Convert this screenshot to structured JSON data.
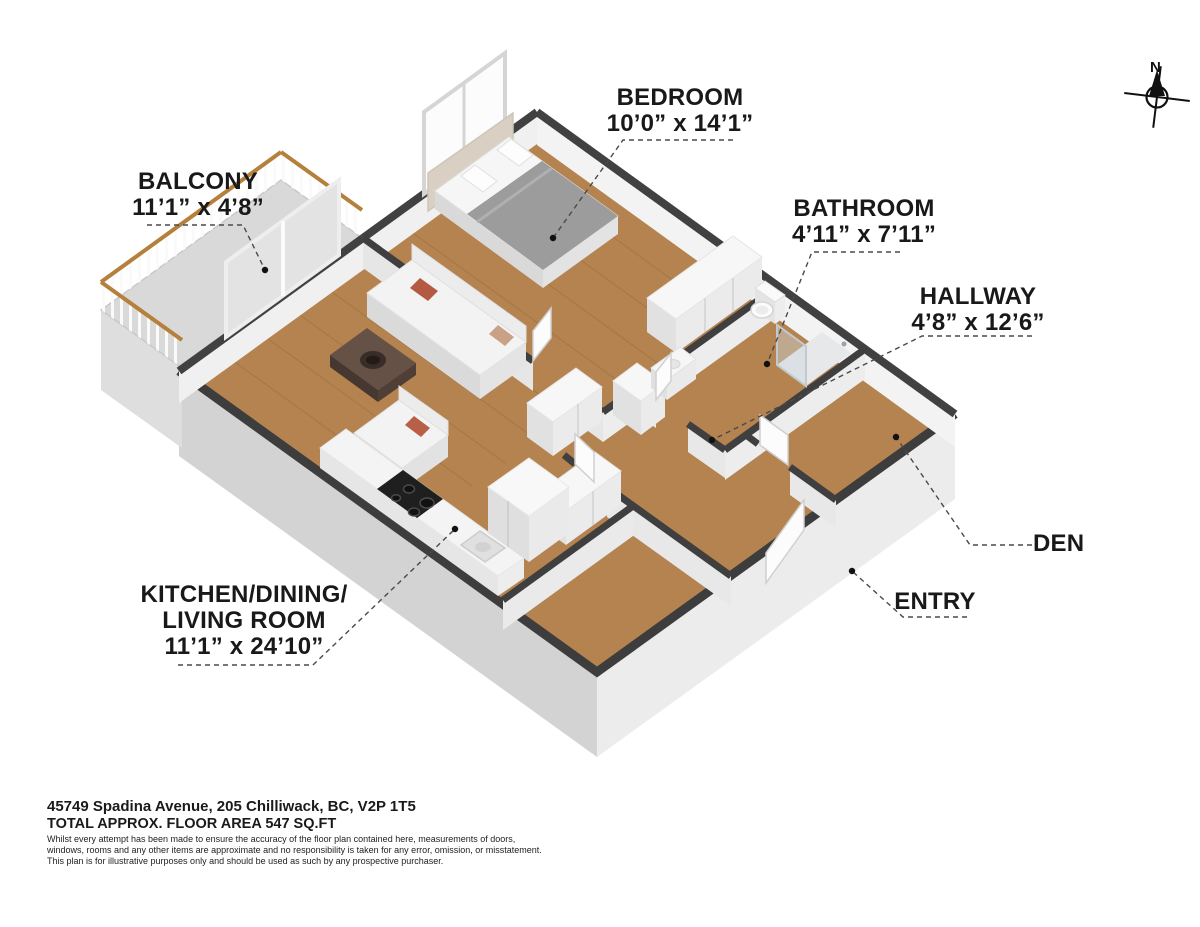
{
  "compass": {
    "label": "N"
  },
  "rooms": {
    "bedroom": {
      "label": "BEDROOM",
      "dims": "10’0” x 14’1”"
    },
    "balcony": {
      "label": "BALCONY",
      "dims": "11’1” x 4’8”"
    },
    "bathroom": {
      "label": "BATHROOM",
      "dims": "4’11” x 7’11”"
    },
    "hallway": {
      "label": "HALLWAY",
      "dims": "4’8” x 12’6”"
    },
    "den": {
      "label": "DEN"
    },
    "entry": {
      "label": "ENTRY"
    },
    "kitchen": {
      "line1": "KITCHEN/DINING/",
      "line2": "LIVING ROOM",
      "dims": "11’1” x 24’10”"
    }
  },
  "footer": {
    "address": "45749 Spadina Avenue, 205 Chilliwack, BC, V2P 1T5",
    "area": "TOTAL APPROX. FLOOR AREA 547 SQ.FT",
    "disclaimer_line1": "Whilst every attempt has been made to ensure the accuracy of the floor plan contained here, measurements of doors,",
    "disclaimer_line2": "windows, rooms and any other items are approximate and no responsibility is taken for any error, omission, or misstatement.",
    "disclaimer_line3": "This plan is for illustrative purposes only and should be used as such by any prospective purchaser."
  },
  "colors": {
    "wall_cap": "#3f3f3f",
    "wood_floor": "#b5834f",
    "balcony_floor": "#d9d9d9",
    "rail_wood": "#b5803c",
    "accent_pillow": "#b45a42",
    "slab_light": "#ececec",
    "slab_shadow": "#d3d3d3"
  }
}
